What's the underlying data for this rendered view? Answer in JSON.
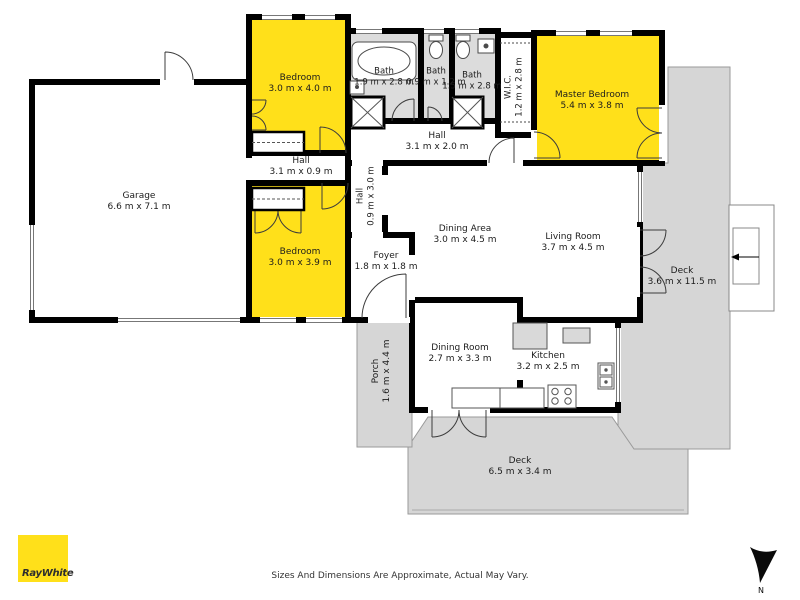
{
  "plan": {
    "rooms": [
      {
        "name": "Garage",
        "dims": "6.6 m x 7.1 m"
      },
      {
        "name": "Bedroom",
        "dims": "3.0 m x 4.0 m"
      },
      {
        "name": "Bath",
        "dims": "1.9 m x 2.8 m"
      },
      {
        "name": "Bath",
        "dims": "0.9 m x 1.2 m"
      },
      {
        "name": "Bath",
        "dims": "1.5 m x 2.8 m"
      },
      {
        "name": "W.I.C.",
        "dims": "1.2 m x 2.8 m"
      },
      {
        "name": "Master Bedroom",
        "dims": "5.4 m x 3.8 m"
      },
      {
        "name": "Hall",
        "dims": "3.1 m x 2.0 m"
      },
      {
        "name": "Hall",
        "dims": "3.1 m x 0.9 m"
      },
      {
        "name": "Hall",
        "dims": "0.9 m x 3.0 m"
      },
      {
        "name": "Bedroom",
        "dims": "3.0 m x 3.9 m"
      },
      {
        "name": "Dining Area",
        "dims": "3.0 m x 4.5 m"
      },
      {
        "name": "Living Room",
        "dims": "3.7 m x 4.5 m"
      },
      {
        "name": "Foyer",
        "dims": "1.8 m x 1.8 m"
      },
      {
        "name": "Deck",
        "dims": "3.6 m x 11.5 m"
      },
      {
        "name": "Dining Room",
        "dims": "2.7 m x 3.3 m"
      },
      {
        "name": "Kitchen",
        "dims": "3.2 m x 2.5 m"
      },
      {
        "name": "Porch",
        "dims": "1.6 m x 4.4 m"
      },
      {
        "name": "Deck",
        "dims": "6.5 m x 3.4 m"
      }
    ],
    "colors": {
      "highlight_room": "#ffe01a",
      "deck": "#d6d6d6",
      "bath_floor": "#dcdcdc",
      "wall": "#000000"
    }
  },
  "footer": {
    "disclaimer": "Sizes And Dimensions Are Approximate, Actual May Vary.",
    "logo_text": "RayWhite",
    "north_label": "N"
  }
}
